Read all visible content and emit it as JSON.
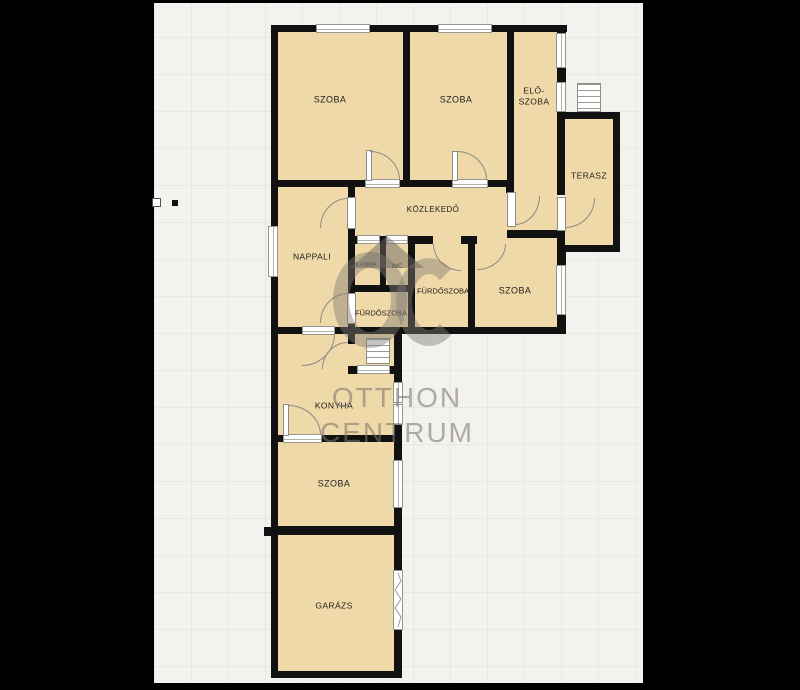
{
  "watermark": {
    "monogram": "OC",
    "brand_line1": "OTTHON",
    "brand_line2": "CENTRUM"
  },
  "rooms": {
    "szoba_top_left": {
      "label": "SZOBA"
    },
    "szoba_top_mid": {
      "label": "SZOBA"
    },
    "eloszoba": {
      "label": "ELŐ-SZOBA",
      "line1": "ELŐ-",
      "line2": "SZOBA"
    },
    "terasz": {
      "label": "TERASZ"
    },
    "kozlekedo": {
      "label": "KÖZLEKEDŐ"
    },
    "nappali": {
      "label": "NAPPALI"
    },
    "kamra": {
      "label": "KAMRA"
    },
    "wc": {
      "label": "WC"
    },
    "furdoszoba_felso": {
      "label": "FÜRDŐSZOBA"
    },
    "szoba_kozep": {
      "label": "SZOBA"
    },
    "furdoszoba_also": {
      "label": "FÜRDŐSZOBA"
    },
    "konyha": {
      "label": "KONYHA"
    },
    "szoba_also": {
      "label": "SZOBA"
    },
    "garazs": {
      "label": "GARÁZS"
    }
  },
  "colors": {
    "floor": "#f0d9a8",
    "wall": "#111111",
    "background_grid": "#f3f2ee",
    "grid_line": "#e8e7e1",
    "watermark_gray": "#7d796f",
    "frame": "#000000"
  }
}
